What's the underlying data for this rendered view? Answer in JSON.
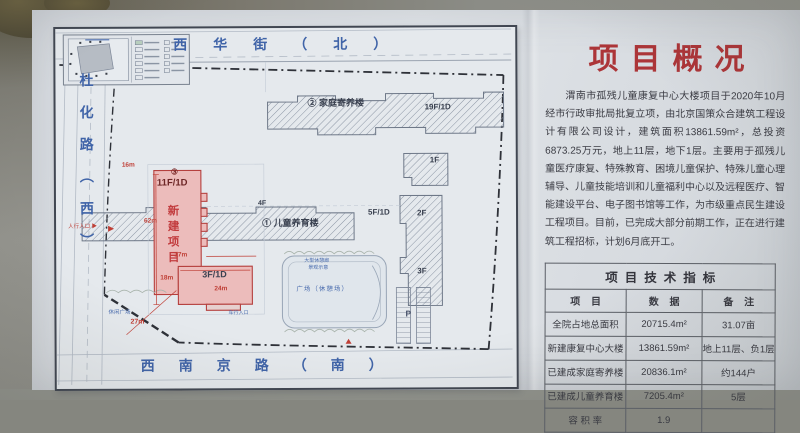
{
  "overview": {
    "title": "项目概况",
    "body": "渭南市孤残儿童康复中心大楼项目于2020年10月经市行政审批局批复立项，由北京国策众合建筑工程设计有限公司设计，建筑面积13861.59m²，总投资6873.25万元，地上11层，地下1层。主要用于孤残儿童医疗康复、特殊教育、困境儿童保护、特殊儿童心理辅导、儿童技能培训和儿童福利中心以及远程医疗、智能建设平台、电子图书馆等工作，为市级重点民生建设工程项目。目前，已完成大部分前期工作，正在进行建筑工程招标，计划6月底开工。"
  },
  "table": {
    "title": "项目技术指标",
    "headers": {
      "item": "项 目",
      "data": "数 据",
      "note": "备 注"
    },
    "rows": [
      {
        "item": "全院占地总面积",
        "data": "20715.4m²",
        "note": "31.07亩"
      },
      {
        "item": "新建康复中心大楼",
        "data": "13861.59m²",
        "note": "地上11层、负1层"
      },
      {
        "item": "已建成家庭寄养楼",
        "data": "20836.1m²",
        "note": "约144户"
      },
      {
        "item": "已建成儿童养育楼",
        "data": "7205.4m²",
        "note": "5层"
      },
      {
        "item": "容 积 率",
        "data": "1.9",
        "note": ""
      }
    ]
  },
  "map": {
    "streets": {
      "north": "西华街（北）",
      "west": "杜化路（西）",
      "south": "西南京路（南）"
    },
    "new_building": {
      "number": "③",
      "floors": "11F/1D",
      "name": "新建项目",
      "annex_floors": "3F/1D"
    },
    "foster_building": {
      "label": "② 家庭寄养楼",
      "floors": "19F/1D"
    },
    "nursery_building": {
      "label": "① 儿童养育楼",
      "floors": "5F/1D"
    },
    "floor_tags": {
      "f1": "1F",
      "f2": "2F",
      "f3": "3F",
      "f4": "4F"
    },
    "parking": "P",
    "plaza": "广场（休憩场）",
    "plaza_note1": "大型休憩廊",
    "plaza_note2": "景观示意",
    "leisure": "休闲广场",
    "entrances": {
      "pedestrian": "人行入口 ▶",
      "vehicle": "车行入口"
    },
    "dimensions": {
      "d1": "16m",
      "d2": "62m",
      "d3": "17m",
      "d4": "18m",
      "d5": "24m",
      "d6": "27m"
    }
  },
  "colors": {
    "title_red": "#ac3538",
    "street_blue": "#4064a8",
    "building_pink": "#ecbcbb",
    "board_gray": "#dde1e6"
  }
}
